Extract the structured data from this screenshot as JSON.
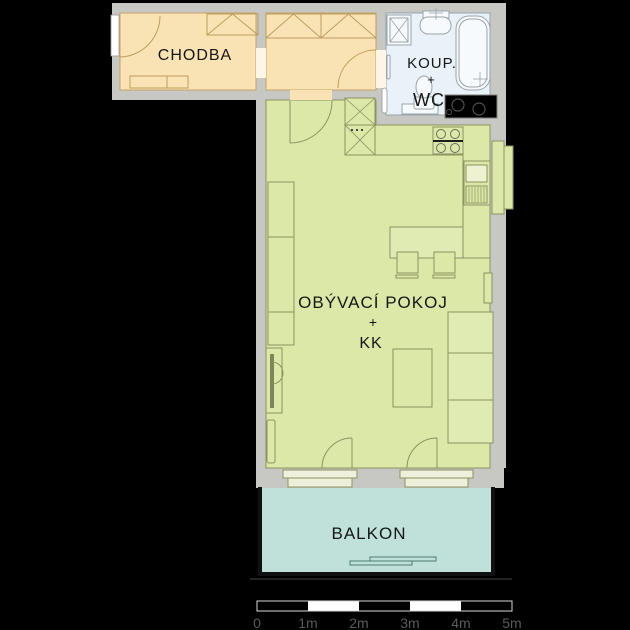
{
  "floorplan": {
    "rooms": {
      "chodba": {
        "label": "CHODBA"
      },
      "bathroom": {
        "label_line1": "KOUP.",
        "label_line2": "+",
        "label_line3": "WC"
      },
      "living": {
        "label_line1": "OBÝVACÍ POKOJ",
        "label_line2": "+",
        "label_line3": "KK"
      },
      "balcony": {
        "label": "BALKON"
      }
    },
    "scale_bar": {
      "labels": [
        "0",
        "1m",
        "2m",
        "3m",
        "4m",
        "5m"
      ]
    },
    "colors": {
      "background": "#000000",
      "wall": "#c7c7c4",
      "hall_floor": "#f9e3b5",
      "bathroom_floor": "#e9f2f8",
      "living_floor": "#dbe8a8",
      "balcony_floor": "#bfe1da",
      "hall_furniture_stroke": "#bf9c5d",
      "living_furniture_stroke": "#8c9360",
      "bath_fixture_stroke": "#9aa4aa",
      "shaft_fill": "#000000",
      "scale_text": "#5a5a5a",
      "label_text": "#161616"
    },
    "icons": [
      "entrance-door-icon",
      "door-arc-icon",
      "wardrobe-icon",
      "shoe-cabinet-icon",
      "washing-machine-icon",
      "washbasin-icon",
      "bathtub-icon",
      "toilet-icon",
      "towel-rail-icon",
      "stove-icon",
      "kitchen-sink-icon",
      "tall-cabinet-icon",
      "radiator-icon",
      "dining-table-icon",
      "chair-icon",
      "sofa-icon",
      "coffee-table-icon",
      "balcony-door-icon",
      "window-icon",
      "shaft-icon",
      "balcony-bench-icon",
      "scale-bar-icon"
    ]
  }
}
